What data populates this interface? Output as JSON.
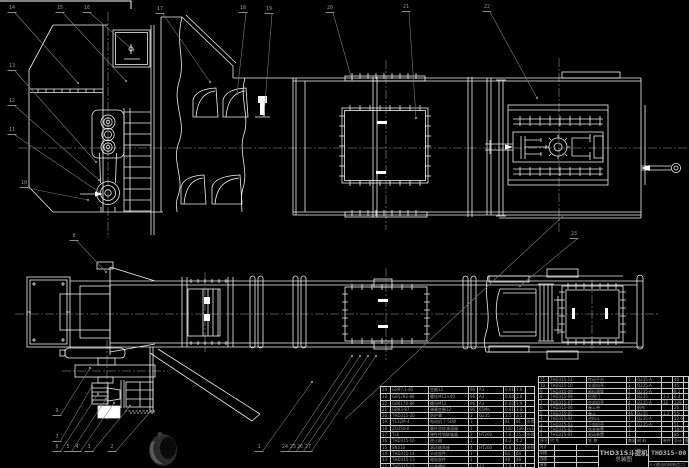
{
  "drawing": {
    "product": "THD315斗提机",
    "view_title": "总装图",
    "drawing_no": "THD315-00",
    "company": "××粮油机械制造二厂",
    "signature_labels": [
      "设计",
      "制图",
      "描图",
      "审核"
    ]
  },
  "colors": {
    "background": "#000000",
    "line": "#f0f0f0",
    "leader": "#7d7d7d",
    "centerline": "#b9b9b9",
    "table_text": "#9e9e9e",
    "table_line": "#c9c9c9",
    "watermark_dark": "#2a2a2a",
    "watermark_light": "#5a5a5a"
  },
  "bom_header": [
    "序号",
    "代 号",
    "名 称",
    "数量",
    "材 料",
    "单件",
    "总计",
    "备注"
  ],
  "bom_right_rows": [
    [
      "11",
      "THD315-11",
      "传动平台",
      "1",
      "Q235-A",
      "",
      "46",
      ""
    ],
    [
      "10",
      "THD315-10",
      "头部机壳",
      "1",
      "Q235-A",
      "",
      "45",
      ""
    ],
    [
      "9",
      "THD315-09",
      "卸料溜管",
      "1",
      "Q235-A",
      "",
      "8.2",
      ""
    ],
    [
      "8",
      "THD315-08",
      "检视门",
      "2",
      "Q235",
      "3.2",
      "6.4",
      ""
    ],
    [
      "7",
      "THD315-07",
      "中部机壳",
      "4",
      "Q235-A",
      "32",
      "128",
      ""
    ],
    [
      "6",
      "THD315-06",
      "畚斗带",
      "1",
      "帆布",
      "",
      "26",
      "B=250"
    ],
    [
      "5",
      "THD315-05",
      "畚斗",
      "46",
      "Q235",
      "1.2",
      "55",
      ""
    ],
    [
      "4",
      "THD315-04",
      "进料斗",
      "1",
      "Q235-A",
      "",
      "12.6",
      ""
    ],
    [
      "3",
      "THD315-03",
      "下部机壳",
      "1",
      "Q235-A",
      "",
      "51",
      ""
    ],
    [
      "2",
      "THD315-02",
      "张紧装置",
      "1",
      "",
      "",
      "18.5",
      ""
    ],
    [
      "1",
      "THD315-01",
      "驱动装置",
      "1",
      "",
      "",
      "86",
      ""
    ]
  ],
  "bom_left_rows": [
    [
      "24",
      "GB97.1-85",
      "垫圈12",
      "96",
      "A3",
      "0.01",
      "1.0",
      ""
    ],
    [
      "23",
      "GB5782-86",
      "螺栓M12×40",
      "96",
      "A3",
      "0.04",
      "3.8",
      ""
    ],
    [
      "22",
      "GB6170-86",
      "螺母M12",
      "96",
      "A3",
      "0.02",
      "1.9",
      ""
    ],
    [
      "21",
      "GB93-87",
      "弹簧垫圈12",
      "96",
      "65Mn",
      "0.01",
      "1.0",
      ""
    ],
    [
      "20",
      "THD315-20",
      "防护罩",
      "1",
      "Q235",
      "3.5",
      "3.5",
      ""
    ],
    [
      "19",
      "Y132M-4",
      "电动机 7.5kW",
      "1",
      "",
      "81",
      "81",
      "外购"
    ],
    [
      "18",
      "ZQ250-Ⅱ",
      "圆柱齿轮减速器",
      "1",
      "",
      "130",
      "130",
      "i=16.3"
    ],
    [
      "17",
      "TL6",
      "弹性柱销联轴器",
      "2",
      "HT200",
      "7.6",
      "15.2",
      "外购"
    ],
    [
      "16",
      "THD315-16",
      "逆止器",
      "1",
      "",
      "4.2",
      "4.2",
      ""
    ],
    [
      "15",
      "SN310",
      "滚动轴承座",
      "4",
      "HT200",
      "6.8",
      "27.2",
      "外购"
    ],
    [
      "14",
      "THD315-14",
      "头轮部件",
      "1",
      "",
      "64",
      "64",
      ""
    ],
    [
      "13",
      "THD315-13",
      "尾轮部件",
      "1",
      "",
      "48",
      "48",
      ""
    ],
    [
      "12",
      "THD315-12",
      "拉紧螺杆",
      "2",
      "A3",
      "1.8",
      "3.6",
      ""
    ]
  ],
  "balloons": [
    {
      "n": "14",
      "x": 12,
      "y": 6,
      "tx": 78,
      "ty": 83
    },
    {
      "n": "15",
      "x": 60,
      "y": 6,
      "tx": 126,
      "ty": 81
    },
    {
      "n": "16",
      "x": 87,
      "y": 6,
      "tx": 133,
      "ty": 50
    },
    {
      "n": "17",
      "x": 160,
      "y": 7,
      "tx": 210,
      "ty": 82
    },
    {
      "n": "18",
      "x": 243,
      "y": 6,
      "tx": 237,
      "ty": 94
    },
    {
      "n": "19",
      "x": 269,
      "y": 7,
      "tx": 264,
      "ty": 116
    },
    {
      "n": "20",
      "x": 330,
      "y": 6,
      "tx": 352,
      "ty": 80
    },
    {
      "n": "21",
      "x": 406,
      "y": 5,
      "tx": 416,
      "ty": 118
    },
    {
      "n": "22",
      "x": 487,
      "y": 5,
      "tx": 537,
      "ty": 98
    },
    {
      "n": "13",
      "x": 12,
      "y": 64,
      "tx": 96,
      "ty": 162
    },
    {
      "n": "12",
      "x": 12,
      "y": 99,
      "tx": 99,
      "ty": 180
    },
    {
      "n": "11",
      "x": 12,
      "y": 128,
      "tx": 102,
      "ty": 194
    },
    {
      "n": "10",
      "x": 24,
      "y": 181,
      "tx": 88,
      "ty": 200
    },
    {
      "n": "8",
      "x": 74,
      "y": 234,
      "tx": 106,
      "ty": 272
    },
    {
      "n": "23",
      "x": 574,
      "y": 232,
      "tx": 520,
      "ty": 286
    },
    {
      "n": "9",
      "x": 57,
      "y": 409,
      "tx": 90,
      "ty": 368
    },
    {
      "n": "7",
      "x": 57,
      "y": 435,
      "tx": 92,
      "ty": 386
    },
    {
      "n": "6",
      "x": 57,
      "y": 445,
      "tx": 98,
      "ty": 394
    },
    {
      "n": "5",
      "x": 68,
      "y": 445,
      "tx": 106,
      "ty": 399
    },
    {
      "n": "4",
      "x": 77,
      "y": 445,
      "tx": 114,
      "ty": 403
    },
    {
      "n": "3",
      "x": 89,
      "y": 445,
      "tx": 130,
      "ty": 406
    },
    {
      "n": "2",
      "x": 112,
      "y": 445,
      "tx": 151,
      "ty": 411
    },
    {
      "n": "1",
      "x": 259,
      "y": 445,
      "tx": 312,
      "ty": 382
    },
    {
      "n": "24",
      "x": 285,
      "y": 445,
      "tx": 352,
      "ty": 356
    },
    {
      "n": "25",
      "x": 293,
      "y": 445,
      "tx": 360,
      "ty": 356
    },
    {
      "n": "26",
      "x": 300,
      "y": 445,
      "tx": 368,
      "ty": 356
    },
    {
      "n": "27",
      "x": 308,
      "y": 445,
      "tx": 376,
      "ty": 356
    }
  ]
}
